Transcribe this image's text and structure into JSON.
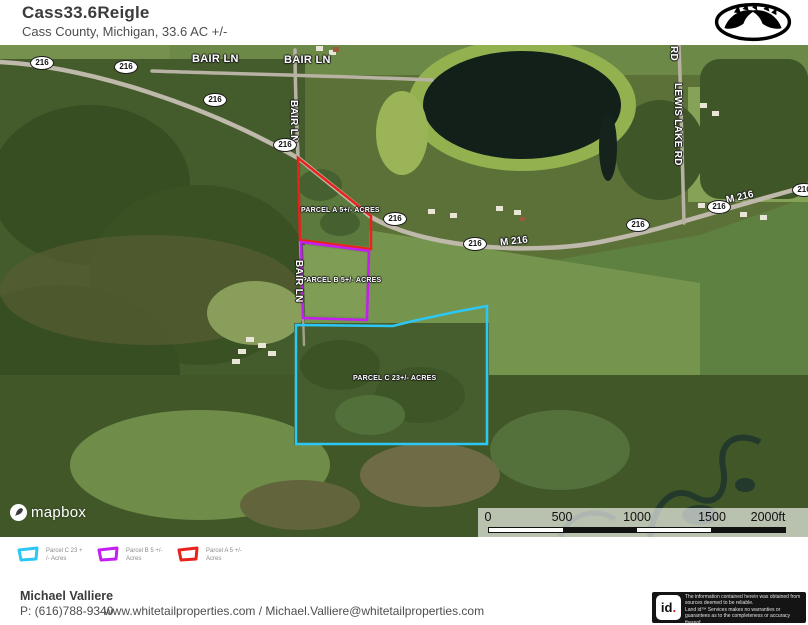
{
  "header": {
    "title": "Cass33.6Reigle",
    "subtitle": "Cass County, Michigan, 33.6 AC +/-"
  },
  "map": {
    "route_badge_label": "216",
    "road_labels": {
      "bair_ln": "BAIR LN",
      "m216": "M 216",
      "lewis_lake_rd": "LEWIS LAKE RD",
      "rd": "RD"
    },
    "parcels": [
      {
        "label": "PARCEL A 5+/- ACRES",
        "color": "#e8231c"
      },
      {
        "label": "PARCEL B 5+/- ACRES",
        "color": "#c41ef0"
      },
      {
        "label": "PARCEL C 23+/- ACRES",
        "color": "#2cc7f5"
      }
    ],
    "attribution": "mapbox",
    "scale": {
      "ticks": [
        "0",
        "500",
        "1000",
        "1500",
        "2000ft"
      ]
    }
  },
  "legend": {
    "items": [
      {
        "line1": "Parcel C 23 +",
        "line2": "/- Acres",
        "color": "#2cc7f5"
      },
      {
        "line1": "Parcel B 5 +/-",
        "line2": "Acres",
        "color": "#c41ef0"
      },
      {
        "line1": "Parcel A 5 +/-",
        "line2": "Acres",
        "color": "#e8231c"
      }
    ]
  },
  "footer": {
    "agent_name": "Michael Valliere",
    "agent_phone": "P: (616)788-9340",
    "contact_line": "www.whitetailproperties.com / Michael.Valliere@whitetailproperties.com",
    "disclaimer": {
      "logo_text": "id",
      "logo_dot": ".",
      "line1": "The information contained herein was obtained from sources deemed to be reliable.",
      "line2": " Land id™ Services makes no warranties or guarantees as to the completeness or accuracy thereof."
    }
  }
}
